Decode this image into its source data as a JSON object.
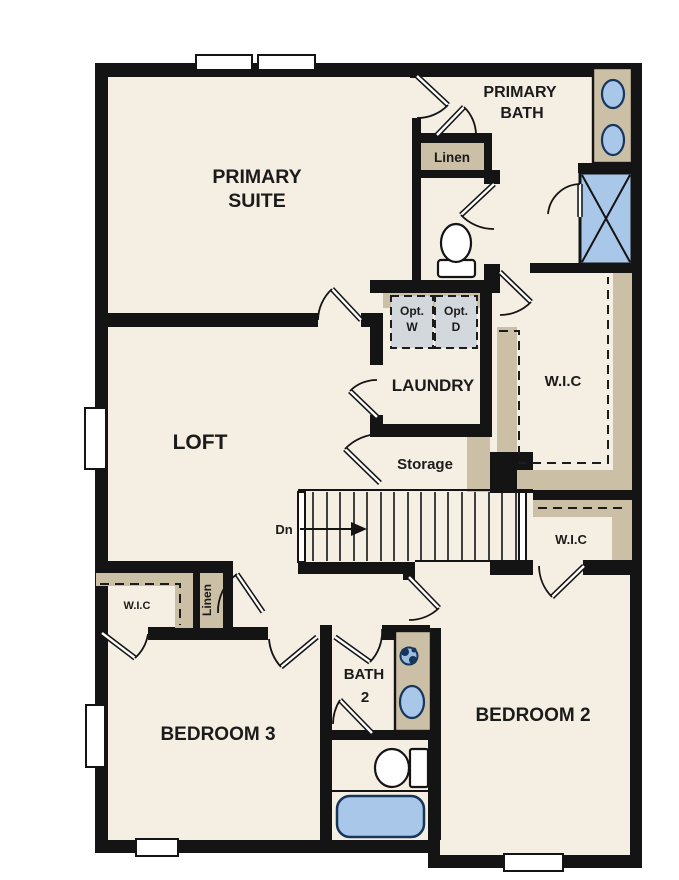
{
  "colors": {
    "wall": "#141414",
    "floor": "#f5efe3",
    "shelf_tan": "#cbbfa6",
    "fixture_blue": "#a9c7e9",
    "fixture_outline": "#16365c",
    "appliance_gray": "#d3d8dc",
    "label_text": "#1b1b1b"
  },
  "rooms": {
    "primary_suite": {
      "line1": "PRIMARY",
      "line2": "SUITE"
    },
    "primary_bath": {
      "line1": "PRIMARY",
      "line2": "BATH"
    },
    "loft": {
      "label": "LOFT"
    },
    "laundry": {
      "label": "LAUNDRY"
    },
    "storage": {
      "label": "Storage"
    },
    "bath2": {
      "line1": "BATH",
      "line2": "2"
    },
    "bedroom2": {
      "label": "BEDROOM 2"
    },
    "bedroom3": {
      "label": "BEDROOM 3"
    }
  },
  "closets": {
    "linen_primary": {
      "label": "Linen"
    },
    "linen_hall": {
      "label": "Linen"
    },
    "wic_primary": {
      "label": "W.I.C"
    },
    "wic_bedroom2": {
      "label": "W.I.C"
    },
    "wic_bedroom3": {
      "label": "W.I.C"
    }
  },
  "appliances": {
    "opt_washer": {
      "line1": "Opt.",
      "line2": "W"
    },
    "opt_dryer": {
      "line1": "Opt.",
      "line2": "D"
    }
  },
  "stairs": {
    "direction_label": "Dn"
  }
}
